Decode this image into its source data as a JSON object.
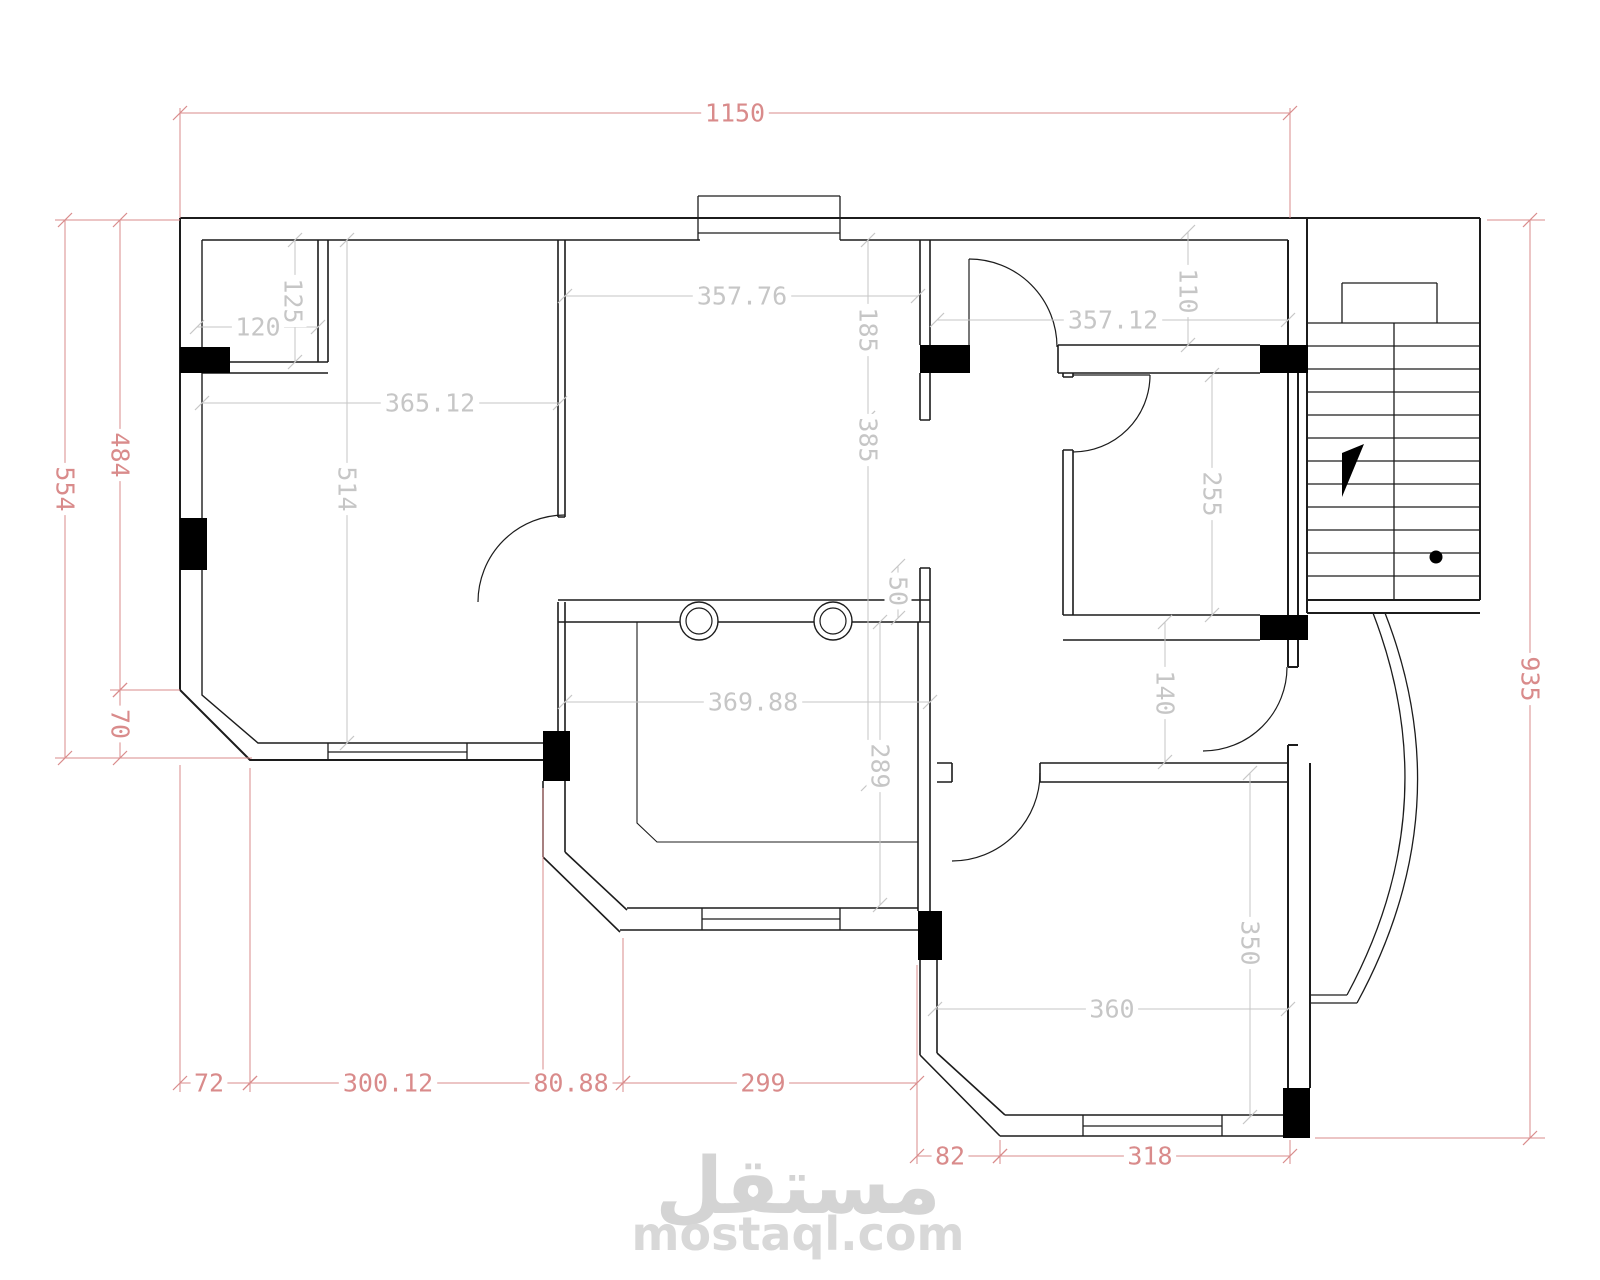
{
  "document": {
    "type": "architectural-floor-plan",
    "background": "#ffffff"
  },
  "colors": {
    "wall": "#1c1c1c",
    "overall_dimension": "#d98b8b",
    "interior_dimension": "#c6c6c6",
    "watermark": "#d4d4d4"
  },
  "watermark": {
    "brand_arabic": "مستقل",
    "brand_domain": "mostaql.com"
  },
  "dimensions": {
    "overall": [
      {
        "label": "1150",
        "line": [
          180,
          113,
          1290,
          113
        ],
        "pos": [
          735,
          113
        ],
        "rot": 0
      },
      {
        "label": "554",
        "line": [
          65,
          220,
          65,
          758
        ],
        "pos": [
          65,
          489
        ],
        "rot": 90
      },
      {
        "label": "484",
        "line": [
          120,
          220,
          120,
          690
        ],
        "pos": [
          120,
          455
        ],
        "rot": 90
      },
      {
        "label": "70",
        "line": [
          120,
          690,
          120,
          758
        ],
        "pos": [
          120,
          724
        ],
        "rot": 90
      },
      {
        "label": "935",
        "line": [
          1530,
          220,
          1530,
          1138
        ],
        "pos": [
          1530,
          679
        ],
        "rot": 90
      },
      {
        "label": "72",
        "line": [
          180,
          1083,
          250,
          1083
        ],
        "pos": [
          209,
          1083
        ],
        "rot": 0
      },
      {
        "label": "300.12",
        "line": [
          250,
          1083,
          543,
          1083
        ],
        "pos": [
          388,
          1083
        ],
        "rot": 0
      },
      {
        "label": "80.88",
        "line": [
          543,
          1083,
          623,
          1083
        ],
        "pos": [
          571,
          1083
        ],
        "rot": 0
      },
      {
        "label": "299",
        "line": [
          623,
          1083,
          917,
          1083
        ],
        "pos": [
          763,
          1083
        ],
        "rot": 0
      },
      {
        "label": "82",
        "line": [
          917,
          1156,
          1000,
          1156
        ],
        "pos": [
          950,
          1156
        ],
        "rot": 0
      },
      {
        "label": "318",
        "line": [
          1000,
          1156,
          1290,
          1156
        ],
        "pos": [
          1150,
          1156
        ],
        "rot": 0
      }
    ],
    "interior": [
      {
        "label": "120",
        "line": [
          197,
          327,
          318,
          327
        ],
        "pos": [
          258,
          327
        ],
        "rot": 0
      },
      {
        "label": "125",
        "line": [
          295,
          240,
          295,
          362
        ],
        "pos": [
          293,
          301
        ],
        "rot": 90
      },
      {
        "label": "365.12",
        "line": [
          202,
          403,
          560,
          403
        ],
        "pos": [
          430,
          403
        ],
        "rot": 0
      },
      {
        "label": "514",
        "line": [
          347,
          240,
          347,
          743
        ],
        "pos": [
          347,
          489
        ],
        "rot": 90
      },
      {
        "label": "357.76",
        "line": [
          565,
          296,
          918,
          296
        ],
        "pos": [
          742,
          296
        ],
        "rot": 0
      },
      {
        "label": "185",
        "line": [
          868,
          240,
          868,
          418
        ],
        "pos": [
          868,
          330
        ],
        "rot": 90
      },
      {
        "label": "385",
        "line": [
          868,
          418,
          868,
          784
        ],
        "pos": [
          868,
          440
        ],
        "rot": 90
      },
      {
        "label": "110",
        "line": [
          1188,
          232,
          1188,
          345
        ],
        "pos": [
          1188,
          291
        ],
        "rot": 90
      },
      {
        "label": "357.12",
        "line": [
          937,
          320,
          1288,
          320
        ],
        "pos": [
          1113,
          320
        ],
        "rot": 0
      },
      {
        "label": "255",
        "line": [
          1212,
          375,
          1212,
          615
        ],
        "pos": [
          1212,
          494
        ],
        "rot": 90
      },
      {
        "label": "50",
        "line": [
          898,
          566,
          898,
          618
        ],
        "pos": [
          898,
          591
        ],
        "rot": 90
      },
      {
        "label": "369.88",
        "line": [
          565,
          702,
          930,
          702
        ],
        "pos": [
          753,
          702
        ],
        "rot": 0
      },
      {
        "label": "289",
        "line": [
          880,
          622,
          880,
          905
        ],
        "pos": [
          880,
          766
        ],
        "rot": 90
      },
      {
        "label": "140",
        "line": [
          1165,
          622,
          1165,
          762
        ],
        "pos": [
          1165,
          693
        ],
        "rot": 90
      },
      {
        "label": "350",
        "line": [
          1250,
          773,
          1250,
          1117
        ],
        "pos": [
          1250,
          943
        ],
        "rot": 90
      },
      {
        "label": "360",
        "line": [
          935,
          1009,
          1288,
          1009
        ],
        "pos": [
          1112,
          1009
        ],
        "rot": 0
      }
    ],
    "extension_lines_overall": [
      [
        180,
        108,
        180,
        218
      ],
      [
        1290,
        108,
        1290,
        218
      ],
      [
        55,
        220,
        180,
        220
      ],
      [
        110,
        690,
        180,
        690
      ],
      [
        55,
        758,
        252,
        758
      ],
      [
        180,
        765,
        180,
        1092
      ],
      [
        250,
        768,
        250,
        1092
      ],
      [
        543,
        788,
        543,
        1092
      ],
      [
        623,
        938,
        623,
        1092
      ],
      [
        917,
        965,
        917,
        1164
      ],
      [
        1000,
        1140,
        1000,
        1164
      ],
      [
        1290,
        1140,
        1290,
        1164
      ],
      [
        1487,
        220,
        1545,
        220
      ],
      [
        1315,
        1138,
        1545,
        1138
      ]
    ]
  },
  "stair": {
    "tread_count": 12,
    "has_direction_triangle": true,
    "has_start_dot": true
  }
}
